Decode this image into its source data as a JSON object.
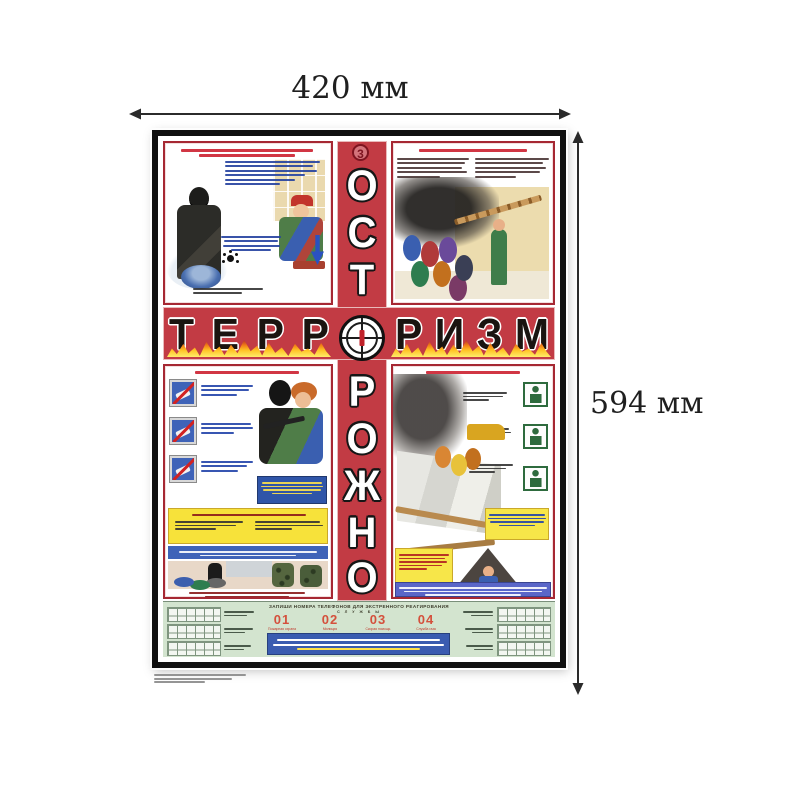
{
  "annotation": {
    "width_label": "420 мм",
    "height_label": "594 мм"
  },
  "poster": {
    "badge_number": "3",
    "title_vertical": "ОСТОРОЖНО",
    "title_horizontal": "ТЕРРОРИЗМ",
    "vertical_letters_top": [
      "О",
      "С",
      "Т"
    ],
    "vertical_letters_bottom": [
      "Р",
      "О",
      "Ж",
      "Н",
      "О"
    ],
    "horizontal_letters_left": [
      "Т",
      "Е",
      "Р",
      "Р"
    ],
    "horizontal_letters_right": [
      "Р",
      "И",
      "З",
      "М"
    ],
    "colors": {
      "band_red": "#c23b44",
      "flame_yellow": "#ffec6a",
      "strip_green": "#d3e4cf",
      "panel_border_red": "#a62833",
      "info_blue": "#3a5cb0",
      "sign_blue": "#3f63b8",
      "warning_yellow": "#f7e23a",
      "number_red": "#d4503c"
    },
    "emergency_strip": {
      "header_line1": "ЗАПИШИ НОМЕРА ТЕЛЕФОНОВ ДЛЯ ЭКСТРЕННОГО РЕАГИРОВАНИЯ",
      "header_line2": "С Л У Ж Б Ы",
      "services": [
        {
          "number": "01",
          "label": "Пожарная охрана"
        },
        {
          "number": "02",
          "label": "Милиция"
        },
        {
          "number": "03",
          "label": "Скорая помощь"
        },
        {
          "number": "04",
          "label": "Служба газа"
        }
      ]
    }
  }
}
